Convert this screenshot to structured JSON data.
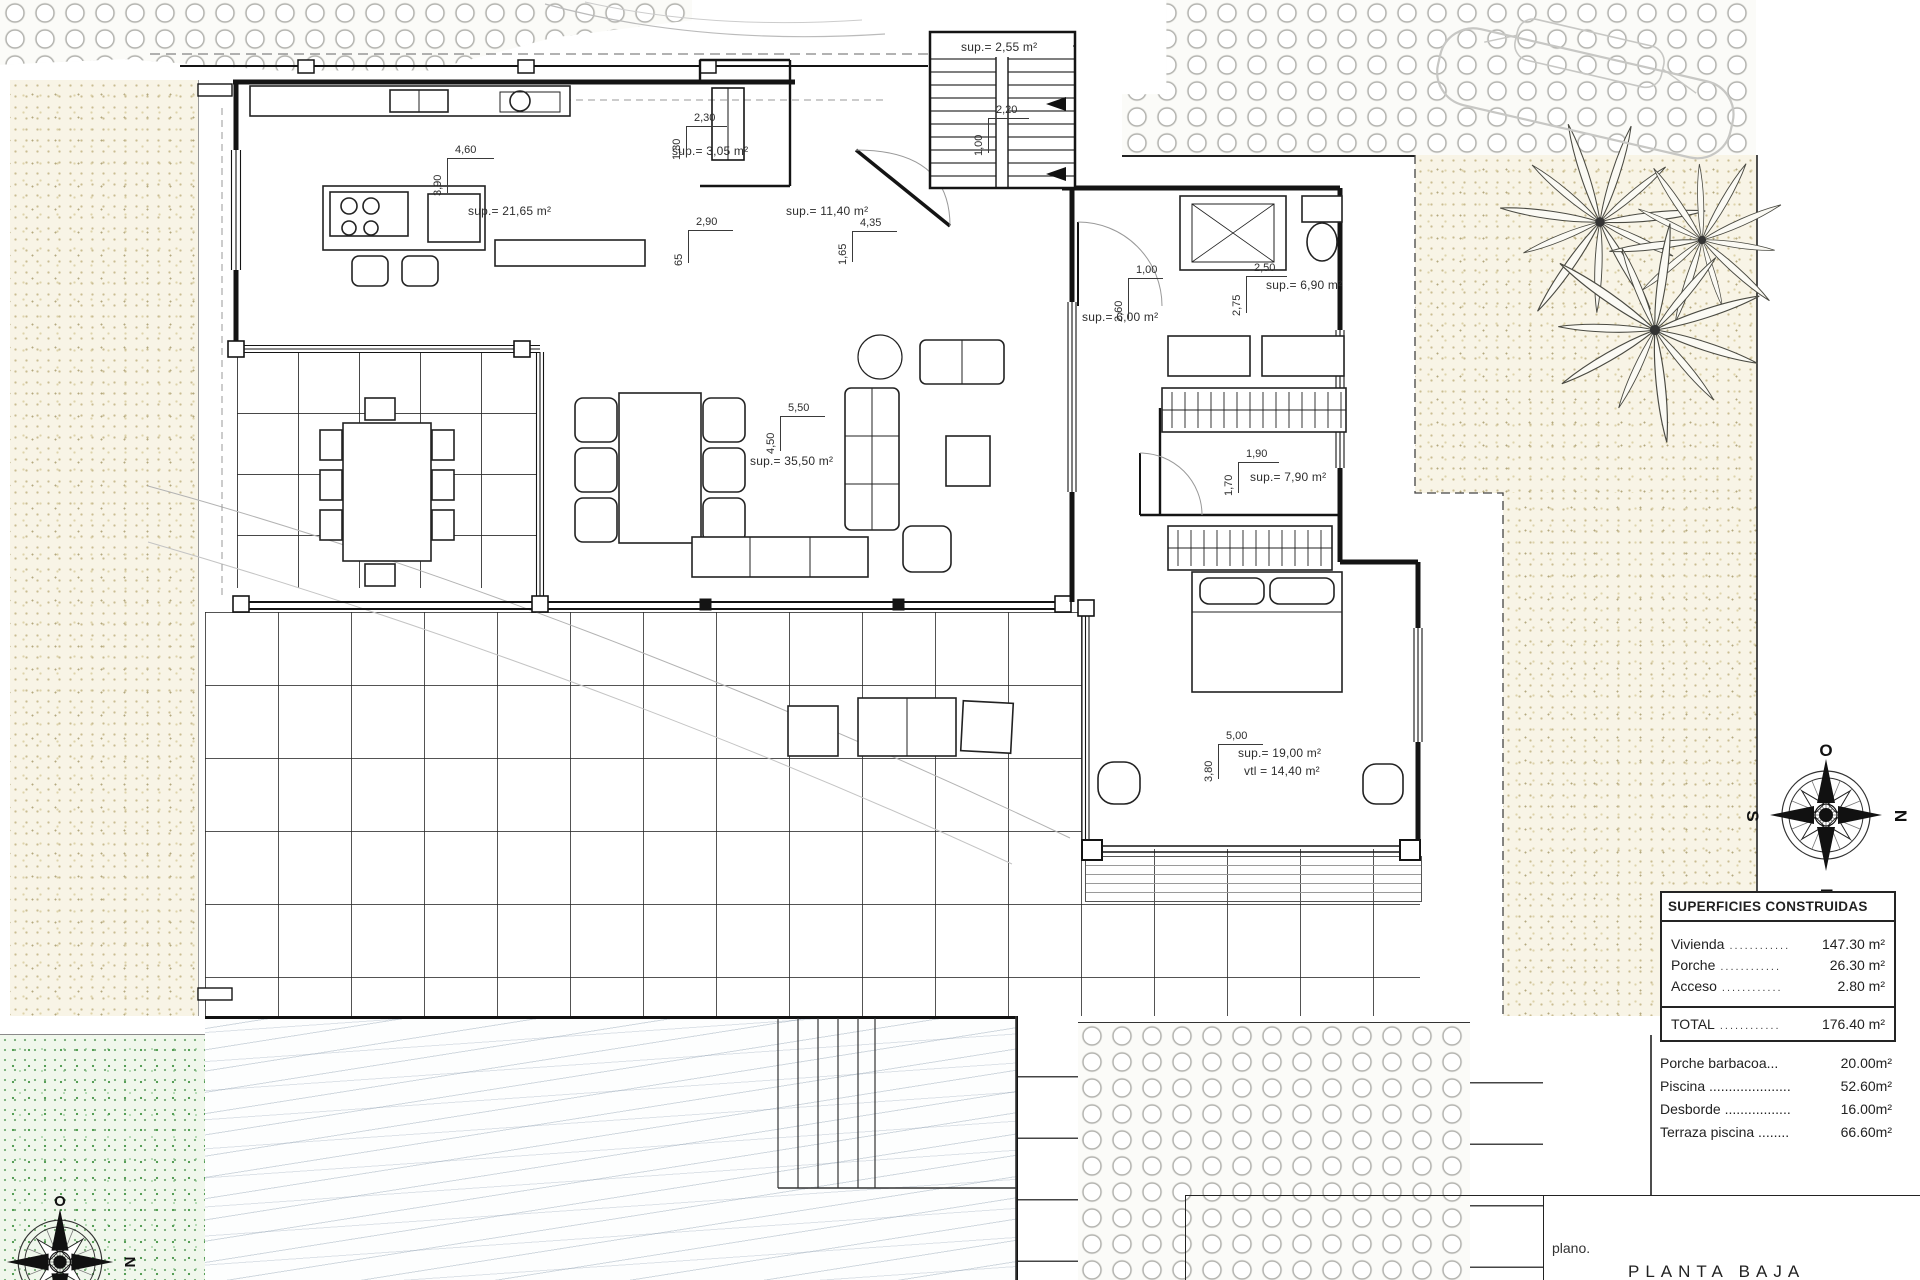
{
  "plan_labels": {
    "stairs_area": "sup.= 2,55 m²",
    "pantry_area": "sup.= 3,05 m²",
    "kitchen_area": "sup.= 21,65 m²",
    "entry_area": "sup.= 11,40 m²",
    "hall_area": "sup.= 6,00 m²",
    "dressing_area": "sup.= 6,90 m²",
    "dressing2_area": "sup.= 7,90 m²",
    "living_area": "sup.= 35,50 m²",
    "bedroom_area": "sup.= 19,00 m²",
    "bedroom_vtl": "vtl = 14,40 m²"
  },
  "dimensions": {
    "kitchen": {
      "w": "4,60",
      "h": "3,90"
    },
    "pantry": {
      "w": "2,30",
      "h": "1,30"
    },
    "mid": {
      "w": "2,90",
      "h": "65"
    },
    "entry": {
      "w": "4,35",
      "h": "1,65"
    },
    "stairs": {
      "w": "2,20",
      "h": "1,00"
    },
    "living": {
      "w": "5,50",
      "h": "4,50"
    },
    "hall": {
      "w": "1,00",
      "h": "2,60"
    },
    "dressing": {
      "w": "2,50",
      "h": "2,75"
    },
    "dressing2": {
      "w": "1,90",
      "h": "1,70"
    },
    "bedroom": {
      "w": "5,00",
      "h": "3,80"
    }
  },
  "areas_table": {
    "header": "SUPERFICIES CONSTRUIDAS",
    "rows": [
      {
        "label": "Vivienda",
        "dots": "............",
        "value": "147.30 m²"
      },
      {
        "label": "Porche",
        "dots": "............",
        "value": "26.30 m²"
      },
      {
        "label": "Acceso",
        "dots": "............",
        "value": "2.80 m²"
      }
    ],
    "total_label": "TOTAL",
    "total_dots": "............",
    "total_value": "176.40 m²",
    "extras": [
      {
        "label": "Porche barbacoa...",
        "value": "20.00m²"
      },
      {
        "label": "Piscina .....................",
        "value": "52.60m²"
      },
      {
        "label": "Desborde .................",
        "value": "16.00m²"
      },
      {
        "label": "Terraza piscina ........",
        "value": "66.60m²"
      }
    ]
  },
  "compass": {
    "o": "O",
    "n": "N",
    "e": "E",
    "s": "S"
  },
  "title_block": {
    "plano": "plano.",
    "plan_name": "PLANTA BAJA"
  }
}
